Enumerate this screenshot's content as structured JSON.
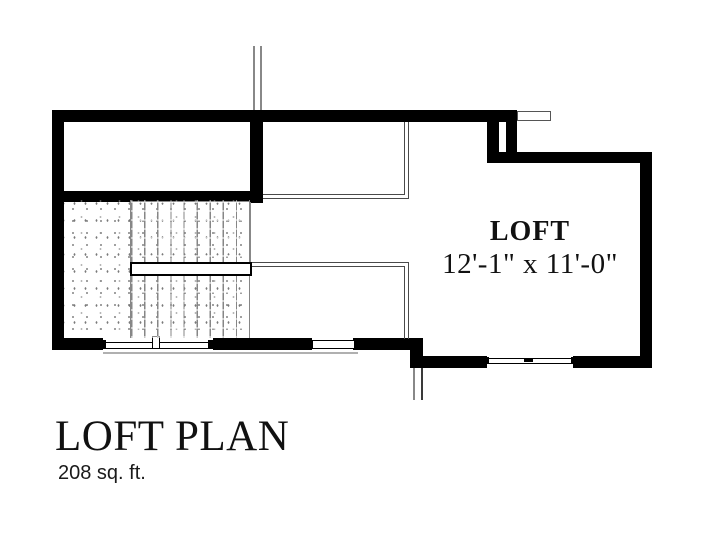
{
  "plan": {
    "title": "LOFT PLAN",
    "area": "208 sq. ft.",
    "room": {
      "label": "LOFT",
      "dimensions": "12'-1\" x 11'-0\""
    },
    "colors": {
      "wall": "#000000",
      "thin_line": "#4a4a4a",
      "tread_line": "#868686"
    }
  }
}
